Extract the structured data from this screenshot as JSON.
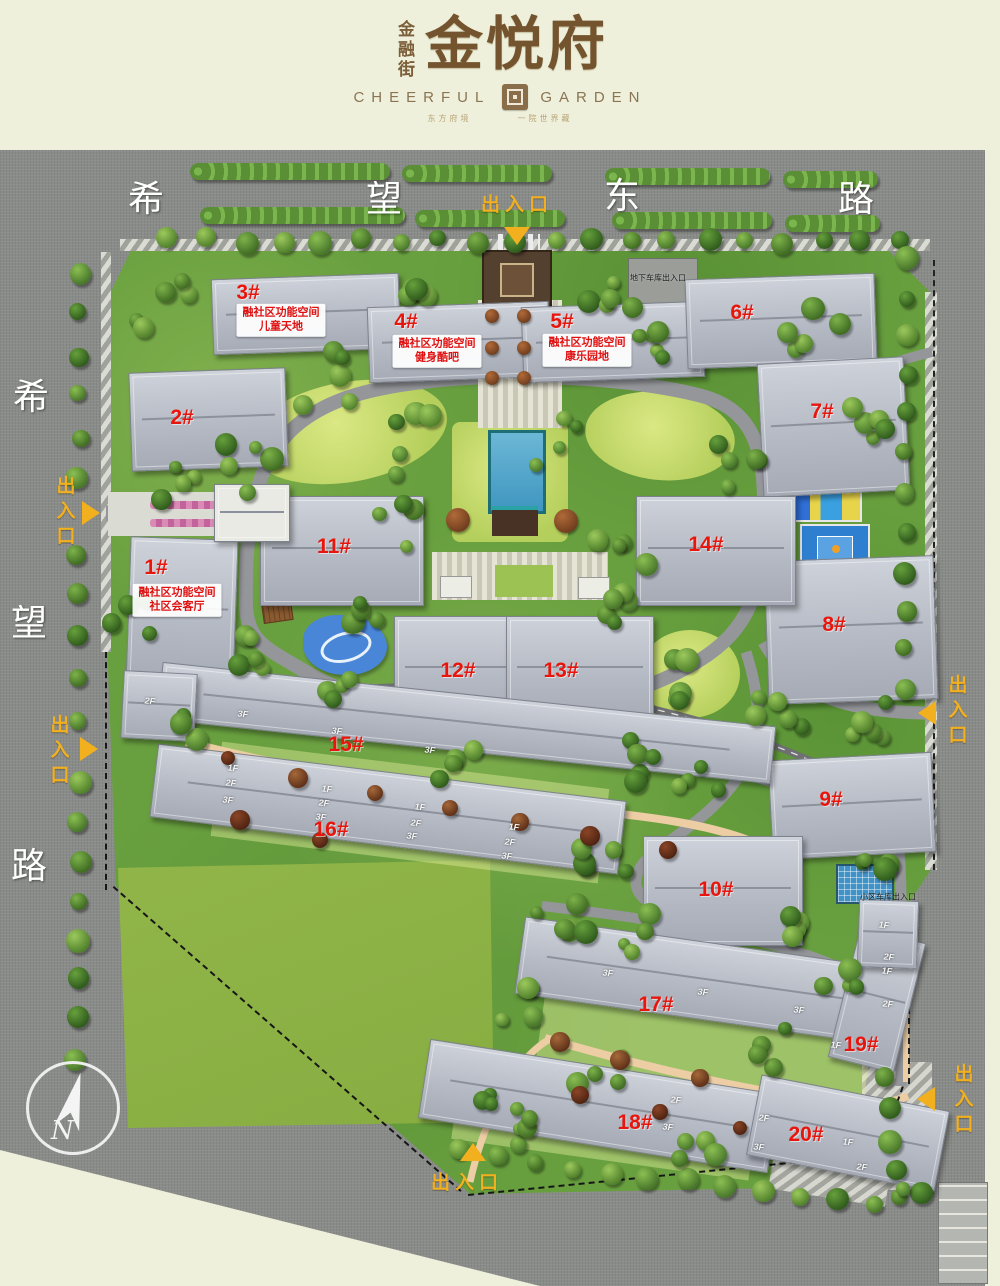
{
  "brand": {
    "name_side": "金融街",
    "name_main": "金悦府",
    "en_left": "CHEERFUL",
    "en_right": "GARDEN",
    "tagline_left": "东方府境",
    "tagline_right": "一院世界藏"
  },
  "roads": {
    "top_chars": [
      {
        "t": "希",
        "x": 146,
        "y": 196
      },
      {
        "t": "望",
        "x": 384,
        "y": 196
      },
      {
        "t": "东",
        "x": 622,
        "y": 193
      },
      {
        "t": "路",
        "x": 856,
        "y": 196
      }
    ],
    "left_chars": [
      {
        "t": "希",
        "x": 31,
        "y": 394
      },
      {
        "t": "望",
        "x": 29,
        "y": 620
      },
      {
        "t": "路",
        "x": 29,
        "y": 863
      }
    ]
  },
  "entrances": [
    {
      "label": "出入口",
      "x": 517,
      "y": 203,
      "vertical": false,
      "dir": "down",
      "ax": 517,
      "ay": 236
    },
    {
      "label": "出入口",
      "x": 64,
      "y": 513,
      "vertical": true,
      "dir": "right",
      "ax": 91,
      "ay": 513
    },
    {
      "label": "出入口",
      "x": 58,
      "y": 752,
      "vertical": true,
      "dir": "right",
      "ax": 89,
      "ay": 749
    },
    {
      "label": "出入口",
      "x": 956,
      "y": 712,
      "vertical": true,
      "dir": "left",
      "ax": 927,
      "ay": 713
    },
    {
      "label": "出入口",
      "x": 962,
      "y": 1101,
      "vertical": true,
      "dir": "left",
      "ax": 926,
      "ay": 1099
    },
    {
      "label": "出入口",
      "x": 467,
      "y": 1181,
      "vertical": false,
      "dir": "up",
      "ax": 473,
      "ay": 1152
    }
  ],
  "buildings": [
    {
      "label": "1#",
      "x": 156,
      "y": 568
    },
    {
      "label": "2#",
      "x": 182,
      "y": 418
    },
    {
      "label": "3#",
      "x": 248,
      "y": 293
    },
    {
      "label": "4#",
      "x": 406,
      "y": 322
    },
    {
      "label": "5#",
      "x": 562,
      "y": 322
    },
    {
      "label": "6#",
      "x": 742,
      "y": 313
    },
    {
      "label": "7#",
      "x": 822,
      "y": 412
    },
    {
      "label": "8#",
      "x": 834,
      "y": 625
    },
    {
      "label": "9#",
      "x": 831,
      "y": 800
    },
    {
      "label": "10#",
      "x": 716,
      "y": 890
    },
    {
      "label": "11#",
      "x": 334,
      "y": 547
    },
    {
      "label": "12#",
      "x": 458,
      "y": 671
    },
    {
      "label": "13#",
      "x": 561,
      "y": 671
    },
    {
      "label": "14#",
      "x": 706,
      "y": 545
    },
    {
      "label": "15#",
      "x": 346,
      "y": 745
    },
    {
      "label": "16#",
      "x": 331,
      "y": 830
    },
    {
      "label": "17#",
      "x": 656,
      "y": 1005
    },
    {
      "label": "18#",
      "x": 635,
      "y": 1123
    },
    {
      "label": "19#",
      "x": 861,
      "y": 1045
    },
    {
      "label": "20#",
      "x": 806,
      "y": 1135
    }
  ],
  "amenities": [
    {
      "line1": "融社区功能空间",
      "line2": "儿童天地",
      "x": 281,
      "y": 320
    },
    {
      "line1": "融社区功能空间",
      "line2": "健身酷吧",
      "x": 437,
      "y": 351
    },
    {
      "line1": "融社区功能空间",
      "line2": "康乐园地",
      "x": 587,
      "y": 350
    },
    {
      "line1": "融社区功能空间",
      "line2": "社区会客厅",
      "x": 177,
      "y": 600
    }
  ],
  "garage_labels": [
    {
      "text": "地下车库出入口",
      "x": 658,
      "y": 278
    },
    {
      "text": "小区车库出入口",
      "x": 888,
      "y": 897
    }
  ],
  "floor_labels": [
    {
      "t": "2F",
      "x": 150,
      "y": 701
    },
    {
      "t": "3F",
      "x": 243,
      "y": 714
    },
    {
      "t": "3F",
      "x": 337,
      "y": 731
    },
    {
      "t": "3F",
      "x": 430,
      "y": 750
    },
    {
      "t": "1F",
      "x": 233,
      "y": 768
    },
    {
      "t": "2F",
      "x": 231,
      "y": 783
    },
    {
      "t": "3F",
      "x": 228,
      "y": 800
    },
    {
      "t": "1F",
      "x": 327,
      "y": 789
    },
    {
      "t": "2F",
      "x": 324,
      "y": 803
    },
    {
      "t": "3F",
      "x": 321,
      "y": 817
    },
    {
      "t": "1F",
      "x": 420,
      "y": 807
    },
    {
      "t": "2F",
      "x": 416,
      "y": 823
    },
    {
      "t": "3F",
      "x": 412,
      "y": 836
    },
    {
      "t": "1F",
      "x": 514,
      "y": 827
    },
    {
      "t": "2F",
      "x": 510,
      "y": 842
    },
    {
      "t": "3F",
      "x": 507,
      "y": 856
    },
    {
      "t": "3F",
      "x": 608,
      "y": 973
    },
    {
      "t": "3F",
      "x": 703,
      "y": 992
    },
    {
      "t": "3F",
      "x": 799,
      "y": 1010
    },
    {
      "t": "1F",
      "x": 887,
      "y": 971
    },
    {
      "t": "2F",
      "x": 888,
      "y": 1004
    },
    {
      "t": "1F",
      "x": 836,
      "y": 1045
    },
    {
      "t": "2F",
      "x": 676,
      "y": 1100
    },
    {
      "t": "3F",
      "x": 668,
      "y": 1127
    },
    {
      "t": "2F",
      "x": 764,
      "y": 1118
    },
    {
      "t": "3F",
      "x": 759,
      "y": 1147
    },
    {
      "t": "1F",
      "x": 848,
      "y": 1142
    },
    {
      "t": "2F",
      "x": 862,
      "y": 1167
    },
    {
      "t": "1F",
      "x": 884,
      "y": 925
    },
    {
      "t": "2F",
      "x": 889,
      "y": 957
    }
  ],
  "compass": {
    "letter": "N"
  },
  "colors": {
    "entrance_yellow": "#f2b01e",
    "building_red": "#e8150c",
    "road_gray": "#8a8c89",
    "site_green": "#69a03f"
  }
}
